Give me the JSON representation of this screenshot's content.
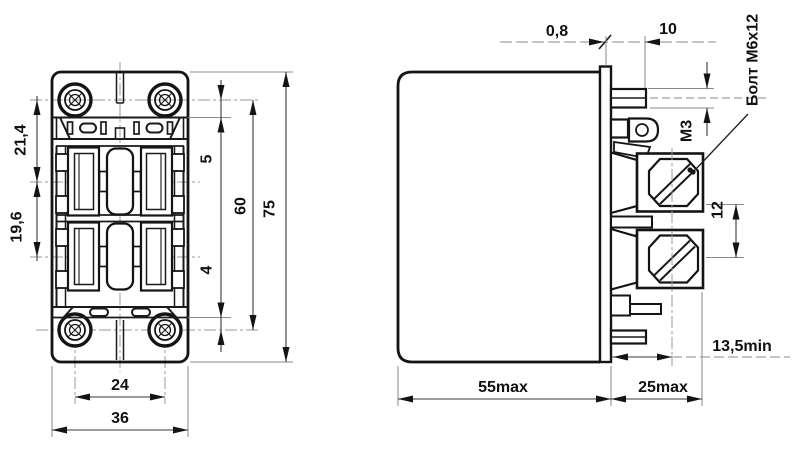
{
  "drawing": {
    "front_view": {
      "dim_screw_to_row1": "21,4",
      "dim_row1_to_row2": "19,6",
      "dim_top_offset": "5",
      "dim_mount_vertical": "60",
      "dim_height": "75",
      "dim_bottom_offset": "4",
      "dim_mount_horizontal": "24",
      "dim_width": "36"
    },
    "side_view": {
      "dim_flange_thickness": "0,8",
      "dim_blade_length": "10",
      "dim_terminal_thread": "М3",
      "bolt_callout": "Болт М6х12",
      "dim_bolt_offset": "12",
      "dim_clearance": "13,5min",
      "dim_depth": "55max",
      "dim_terminal_depth": "25max"
    }
  }
}
